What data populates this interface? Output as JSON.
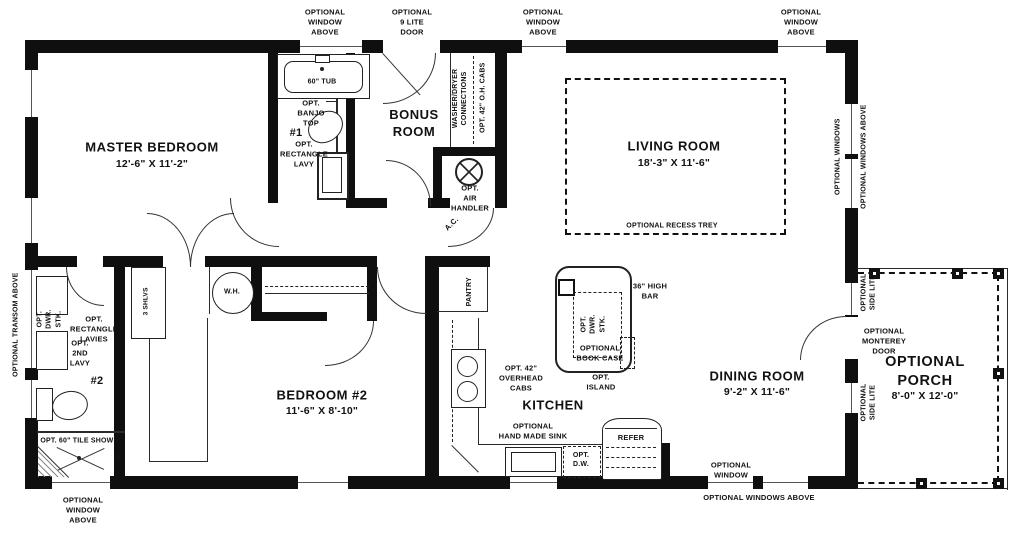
{
  "exterior": {
    "top": [
      "OPTIONAL\nWINDOW\nABOVE",
      "OPTIONAL\n9 LITE\nDOOR",
      "OPTIONAL\nWINDOW\nABOVE",
      "OPTIONAL\nWINDOW\nABOVE"
    ],
    "bottom_window_above": "OPTIONAL\nWINDOW\nABOVE",
    "bottom_window": "OPTIONAL\nWINDOW",
    "bottom_windows_above": "OPTIONAL WINDOWS ABOVE",
    "transom": "OPTIONAL TRANSOM ABOVE",
    "right_windows": "OPTIONAL WINDOWS",
    "right_windows_above": "OPTIONAL WINDOWS ABOVE"
  },
  "rooms": {
    "master": {
      "name": "MASTER BEDROOM",
      "dims": "12'-6\" X 11'-2\""
    },
    "bonus": {
      "name": "BONUS\nROOM"
    },
    "living": {
      "name": "LIVING ROOM",
      "dims": "18'-3\" X 11'-6\"",
      "note": "OPTIONAL RECESS TREY"
    },
    "bedroom2": {
      "name": "BEDROOM #2",
      "dims": "11'-6\" X 8'-10\""
    },
    "kitchen": {
      "name": "KITCHEN"
    },
    "dining": {
      "name": "DINING ROOM",
      "dims": "9'-2\" X 11'-6\""
    },
    "porch": {
      "name": "OPTIONAL\nPORCH",
      "dims": "8'-0\" X 12'-0\""
    }
  },
  "bath1": {
    "tub": "60\" TUB",
    "banjo": "OPT.\nBANJO\nTOP",
    "num": "#1",
    "lavy": "OPT.\nRECTANGLE\nLAVY"
  },
  "bath2": {
    "dwr": "OPT.\nDWR.\nSTK.",
    "lavies": "OPT.\nRECTANGLE\nLAVIES",
    "lavy2": "OPT.\n2ND\nLAVY",
    "num": "#2",
    "shower": "OPT. 60\"  TILE SHOWER"
  },
  "utility": {
    "wd": "WASHER/DRYER\nCONNECTIONS",
    "ohcabs": "OPT. 42\" O.H. CABS",
    "air": "OPT.\nAIR\nHANDLER",
    "ac": "A.C.",
    "wh": "W.H.",
    "shlvs": "3 SHLVS"
  },
  "kit": {
    "pantry": "PANTRY",
    "overhead": "OPT. 42\"\nOVERHEAD\nCABS",
    "sink": "OPTIONAL\nHAND MADE SINK",
    "dw": "OPT.\nD.W.",
    "refer": "REFER",
    "island_dwr": "OPT.\nDWR.\nSTK.",
    "bookcase": "OPTIONAL\nBOOK CASE",
    "island": "OPT.\nISLAND",
    "bar": "36\" HIGH\nBAR"
  },
  "porch": {
    "side_lite1": "OPTIONAL\nSIDE LITE",
    "side_lite2": "OPTIONAL\nSIDE LITE",
    "monterey": "OPTIONAL\nMONTEREY\nDOOR"
  }
}
